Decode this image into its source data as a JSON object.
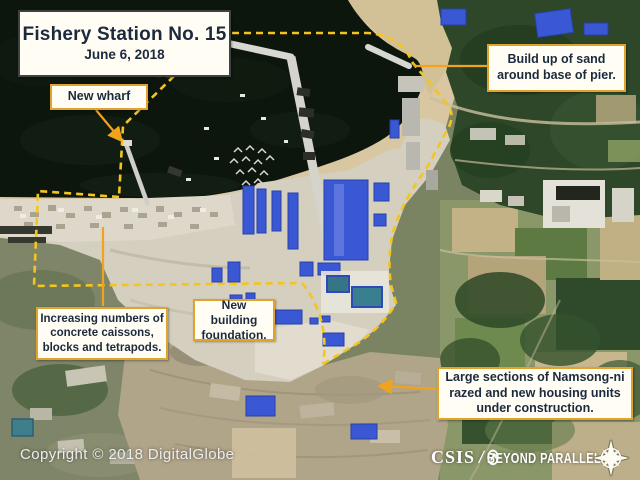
{
  "title_box": {
    "title": "Fishery Station No. 15",
    "date": "June 6, 2018"
  },
  "callouts": {
    "new_wharf": {
      "text": "New wharf"
    },
    "sand_buildup": {
      "text": "Build up of sand around base of pier."
    },
    "caissons": {
      "text": "Increasing numbers of concrete caissons, blocks and tetrapods."
    },
    "foundation": {
      "text": "New building foundation."
    },
    "namsong": {
      "text": "Large sections of Namsong-ni razed and new housing units under construction."
    }
  },
  "footer": {
    "copyright": "Copyright © 2018 DigitalGlobe",
    "logo": {
      "org": "CSIS",
      "separator": "/",
      "program_word1": "BEYOND",
      "program_word2": "PARALLEL",
      "icons": [
        "beyond-parallel-circle-icon",
        "compass-rose-icon"
      ]
    }
  },
  "annotation_colors": {
    "dashed_outline": "#f4c51f",
    "leader_line": "#f2a31d",
    "callout_border": "#dfa32e",
    "title_border": "#3d4340",
    "text": "#1b2a3d"
  }
}
